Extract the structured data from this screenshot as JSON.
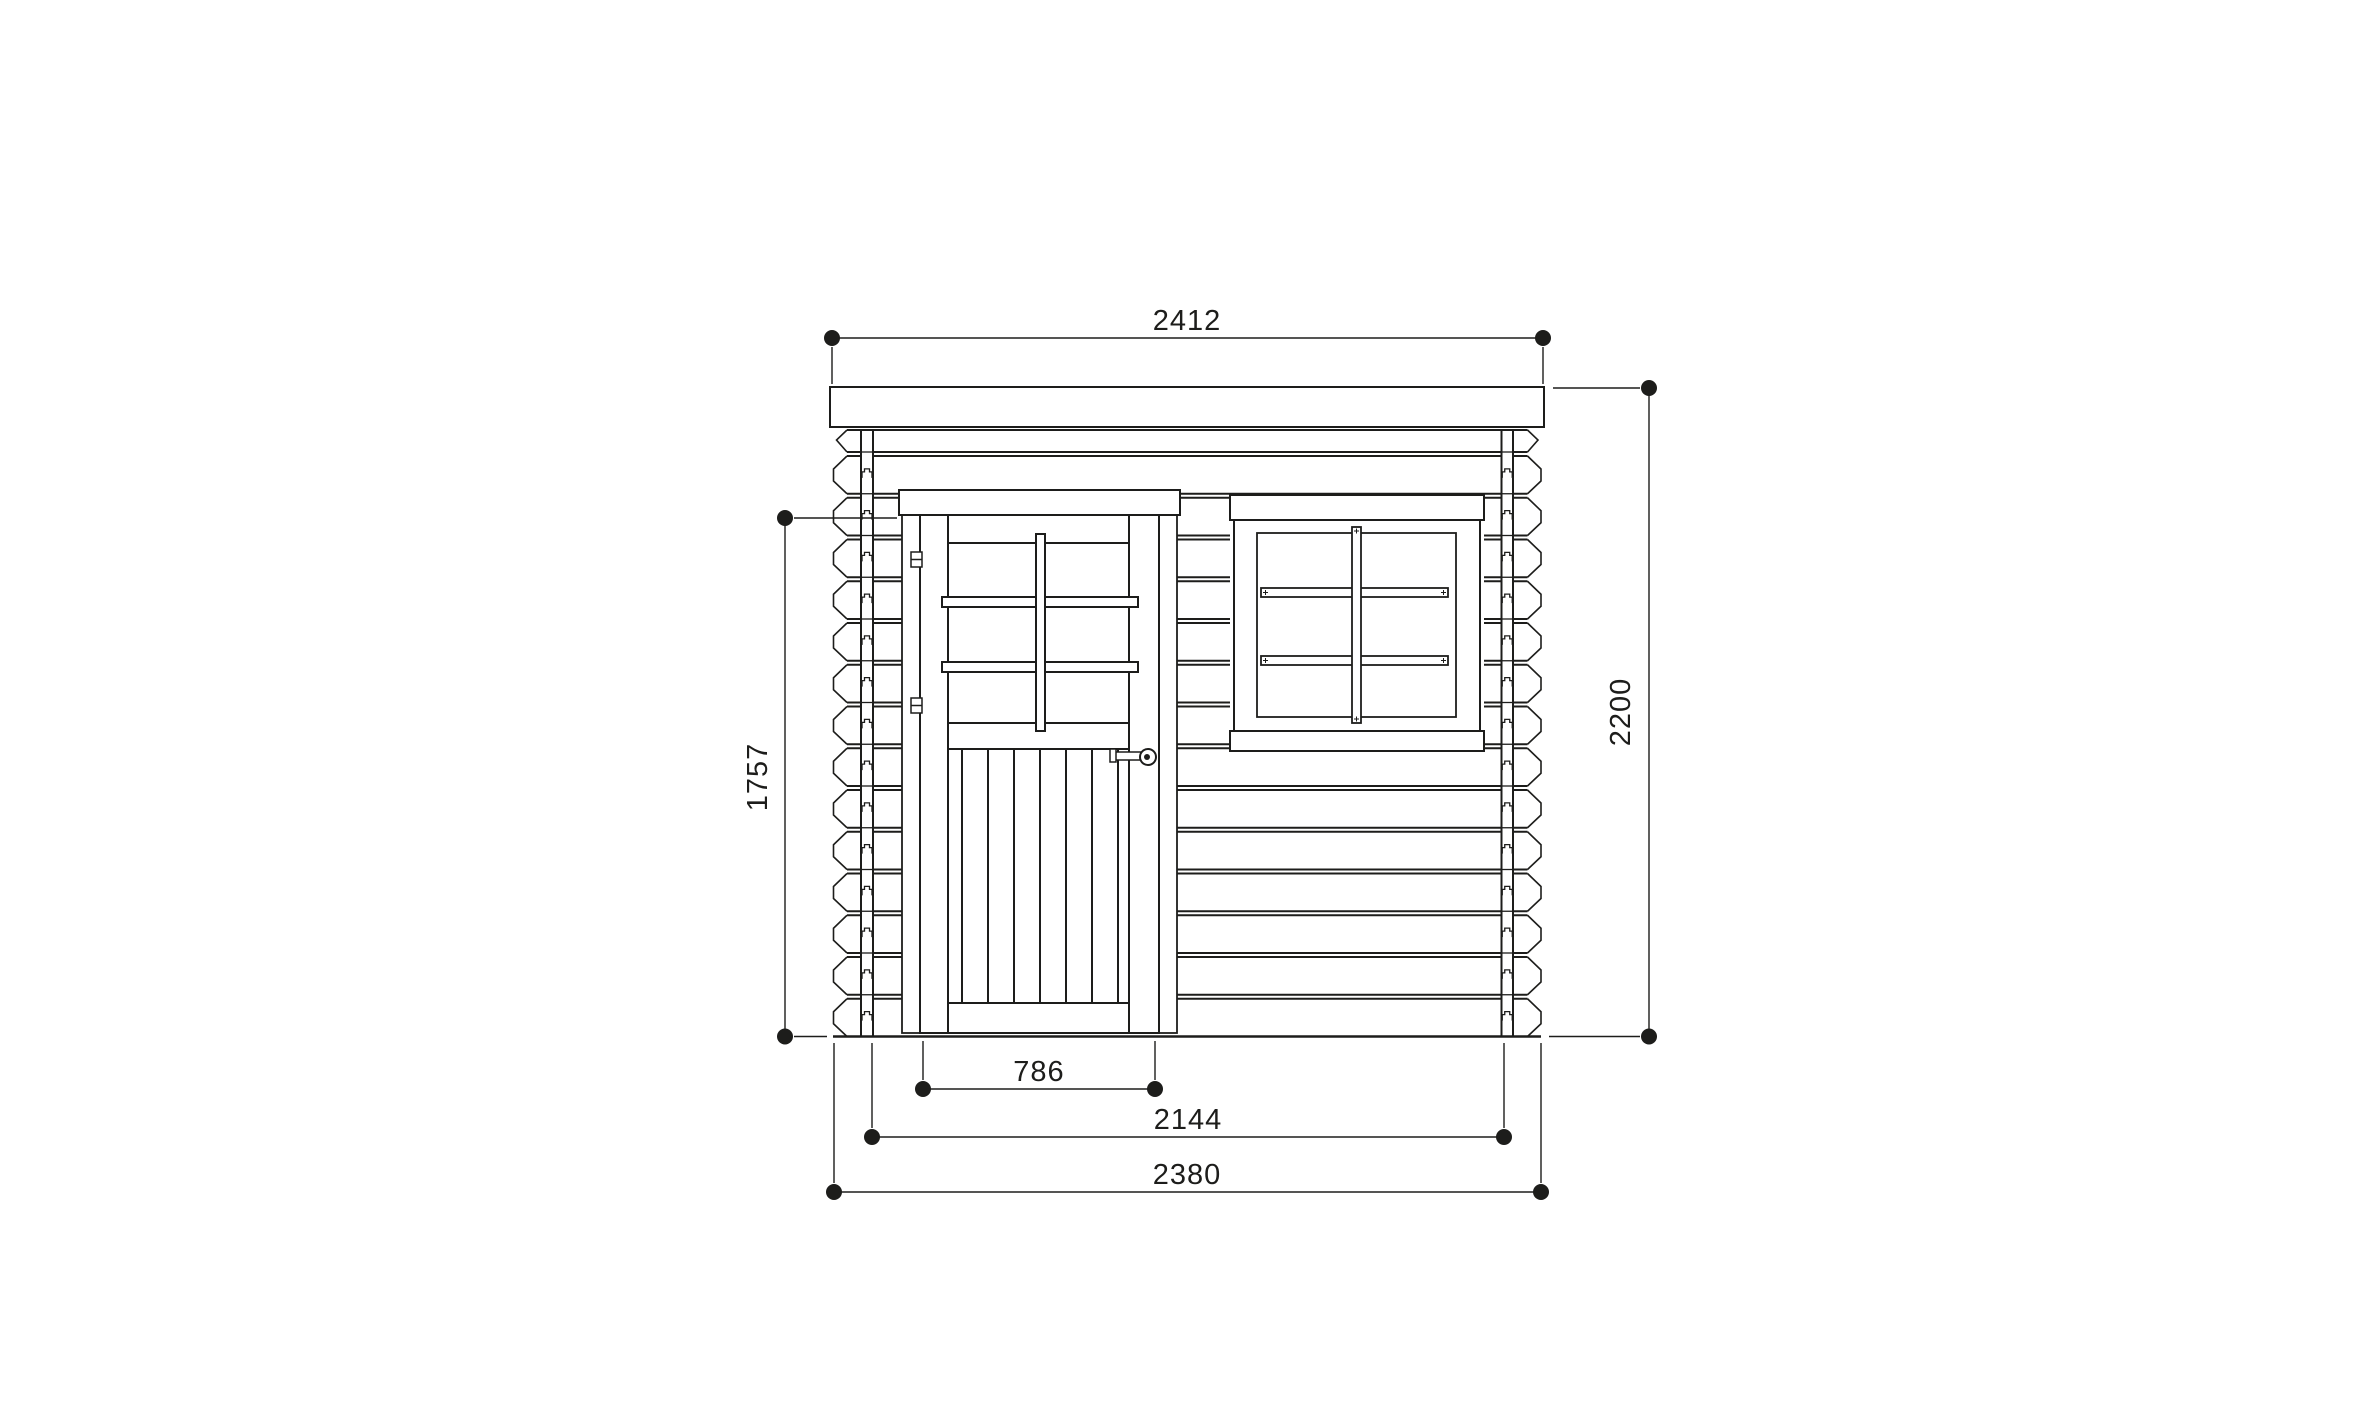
{
  "drawing": {
    "background_color": "#ffffff",
    "line_color": "#1d1d1b",
    "dimensions": {
      "top_width": "2412",
      "right_height": "2200",
      "left_height": "1757",
      "door_width": "786",
      "wall_span": "2144",
      "overall_width": "2380"
    }
  }
}
